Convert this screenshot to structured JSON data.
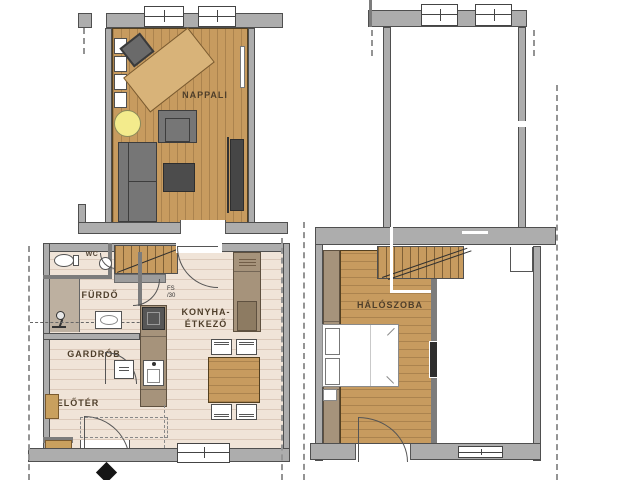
{
  "labels": {
    "living": "NAPPALI",
    "wc": "WC",
    "bath": "FÜRDŐ",
    "wardrobe": "GARDRÓB",
    "hall": "ELŐTÉR",
    "kitchen1": "KONYHA-",
    "kitchen2": "ÉTKEZŐ",
    "bedroom": "HÁLÓSZOBA",
    "door_tag1": "FS",
    "door_tag2": "/30"
  },
  "colors": {
    "wood_floor": "#c79b5f",
    "desk_wood": "#d8b379",
    "tile_floor": "#f0e4d8",
    "wall_gray": "#adadad",
    "furniture_gray": "#767676",
    "furniture_dark": "#4c4c4c",
    "cabinet_taupe": "#a6937b",
    "bench_tan": "#c9a05e",
    "lamp_yellow": "#f3eb8c"
  }
}
